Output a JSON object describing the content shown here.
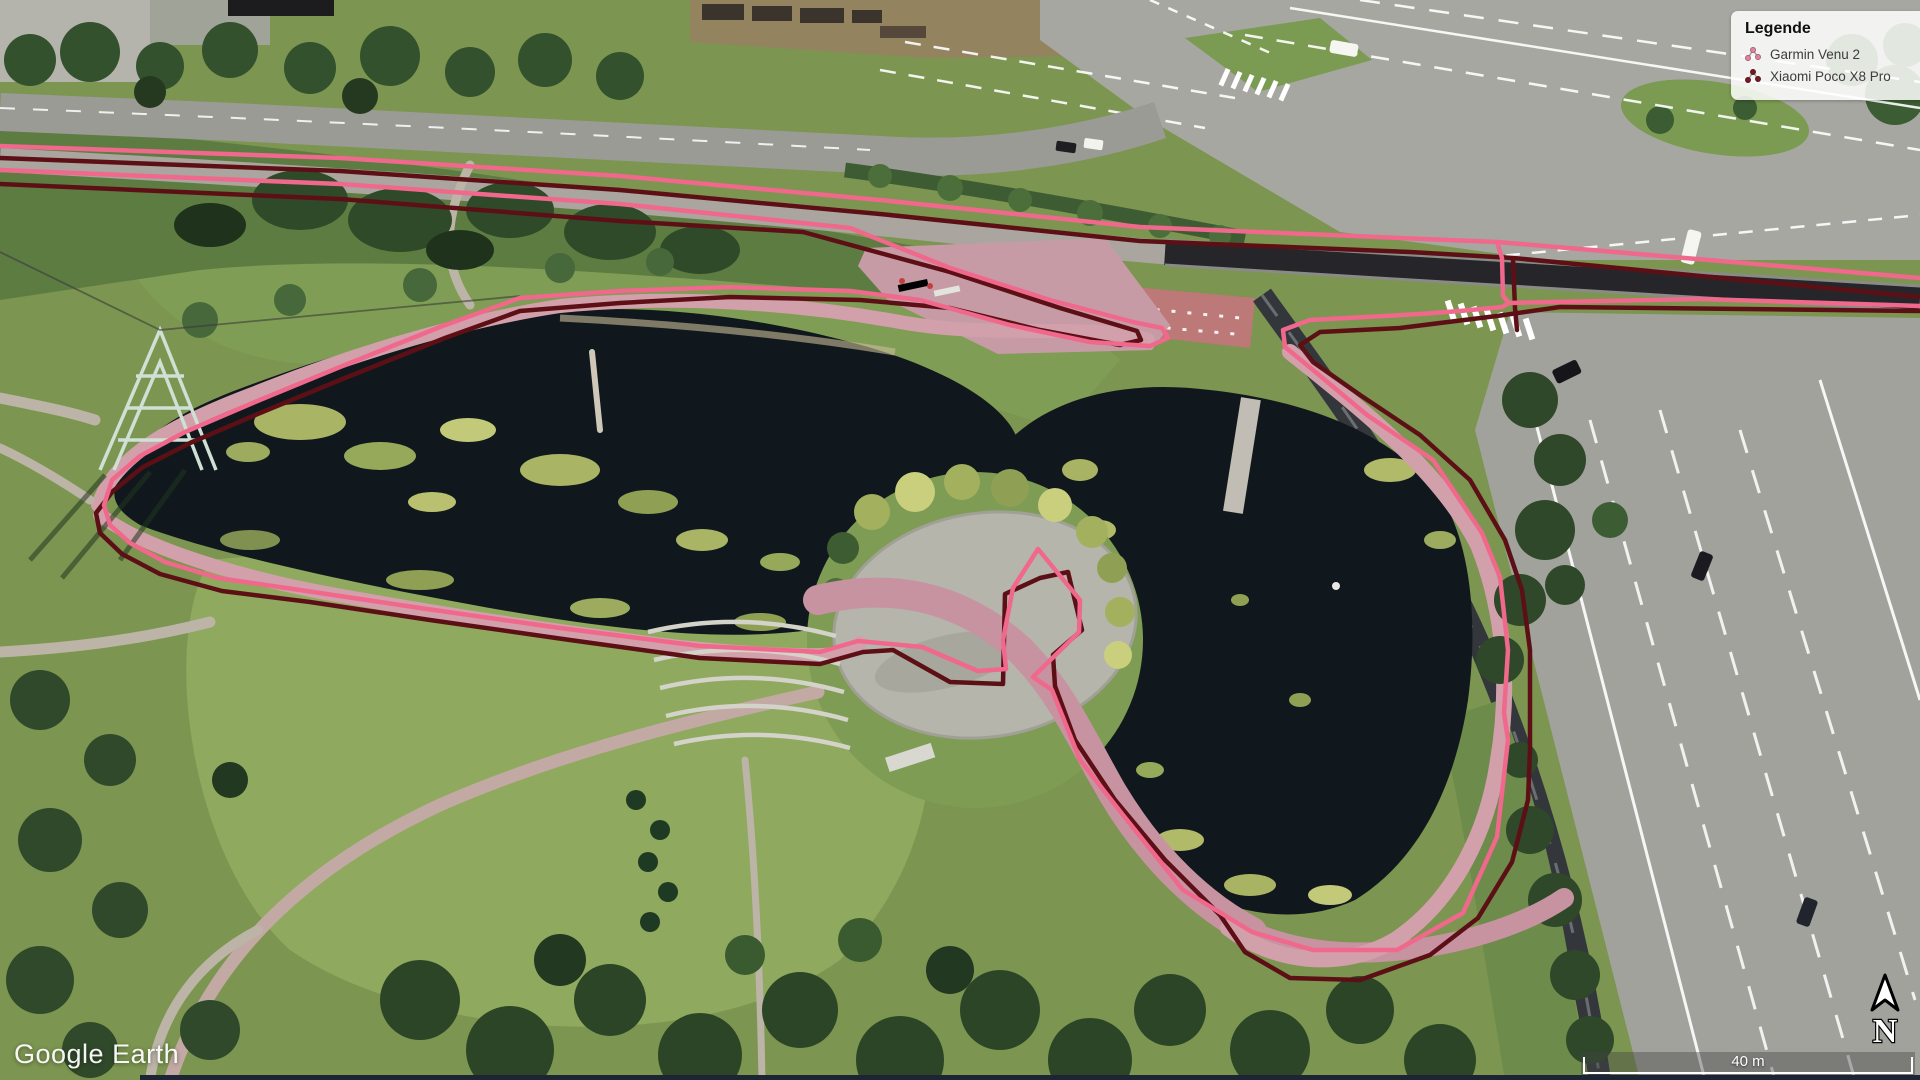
{
  "app": {
    "watermark": "Google Earth"
  },
  "legend": {
    "title": "Legende",
    "items": [
      {
        "label": "Garmin Venu 2",
        "color": "#e87f9a",
        "icon": "track-icon"
      },
      {
        "label": "Xiaomi Poco X8 Pro",
        "color": "#7a1724",
        "icon": "track-icon"
      }
    ]
  },
  "tracks": {
    "garmin_venu_2": {
      "color": "#f0688c",
      "style": "gps-track-line"
    },
    "xiaomi_poco_x8_pro": {
      "color": "#5c1016",
      "style": "gps-track-line"
    }
  },
  "colors": {
    "track_pink": "#f0688c",
    "track_maroon": "#5c1016"
  },
  "map": {
    "type": "satellite-aerial",
    "north_label": "N",
    "scale_bar": {
      "label": "40 m"
    }
  }
}
